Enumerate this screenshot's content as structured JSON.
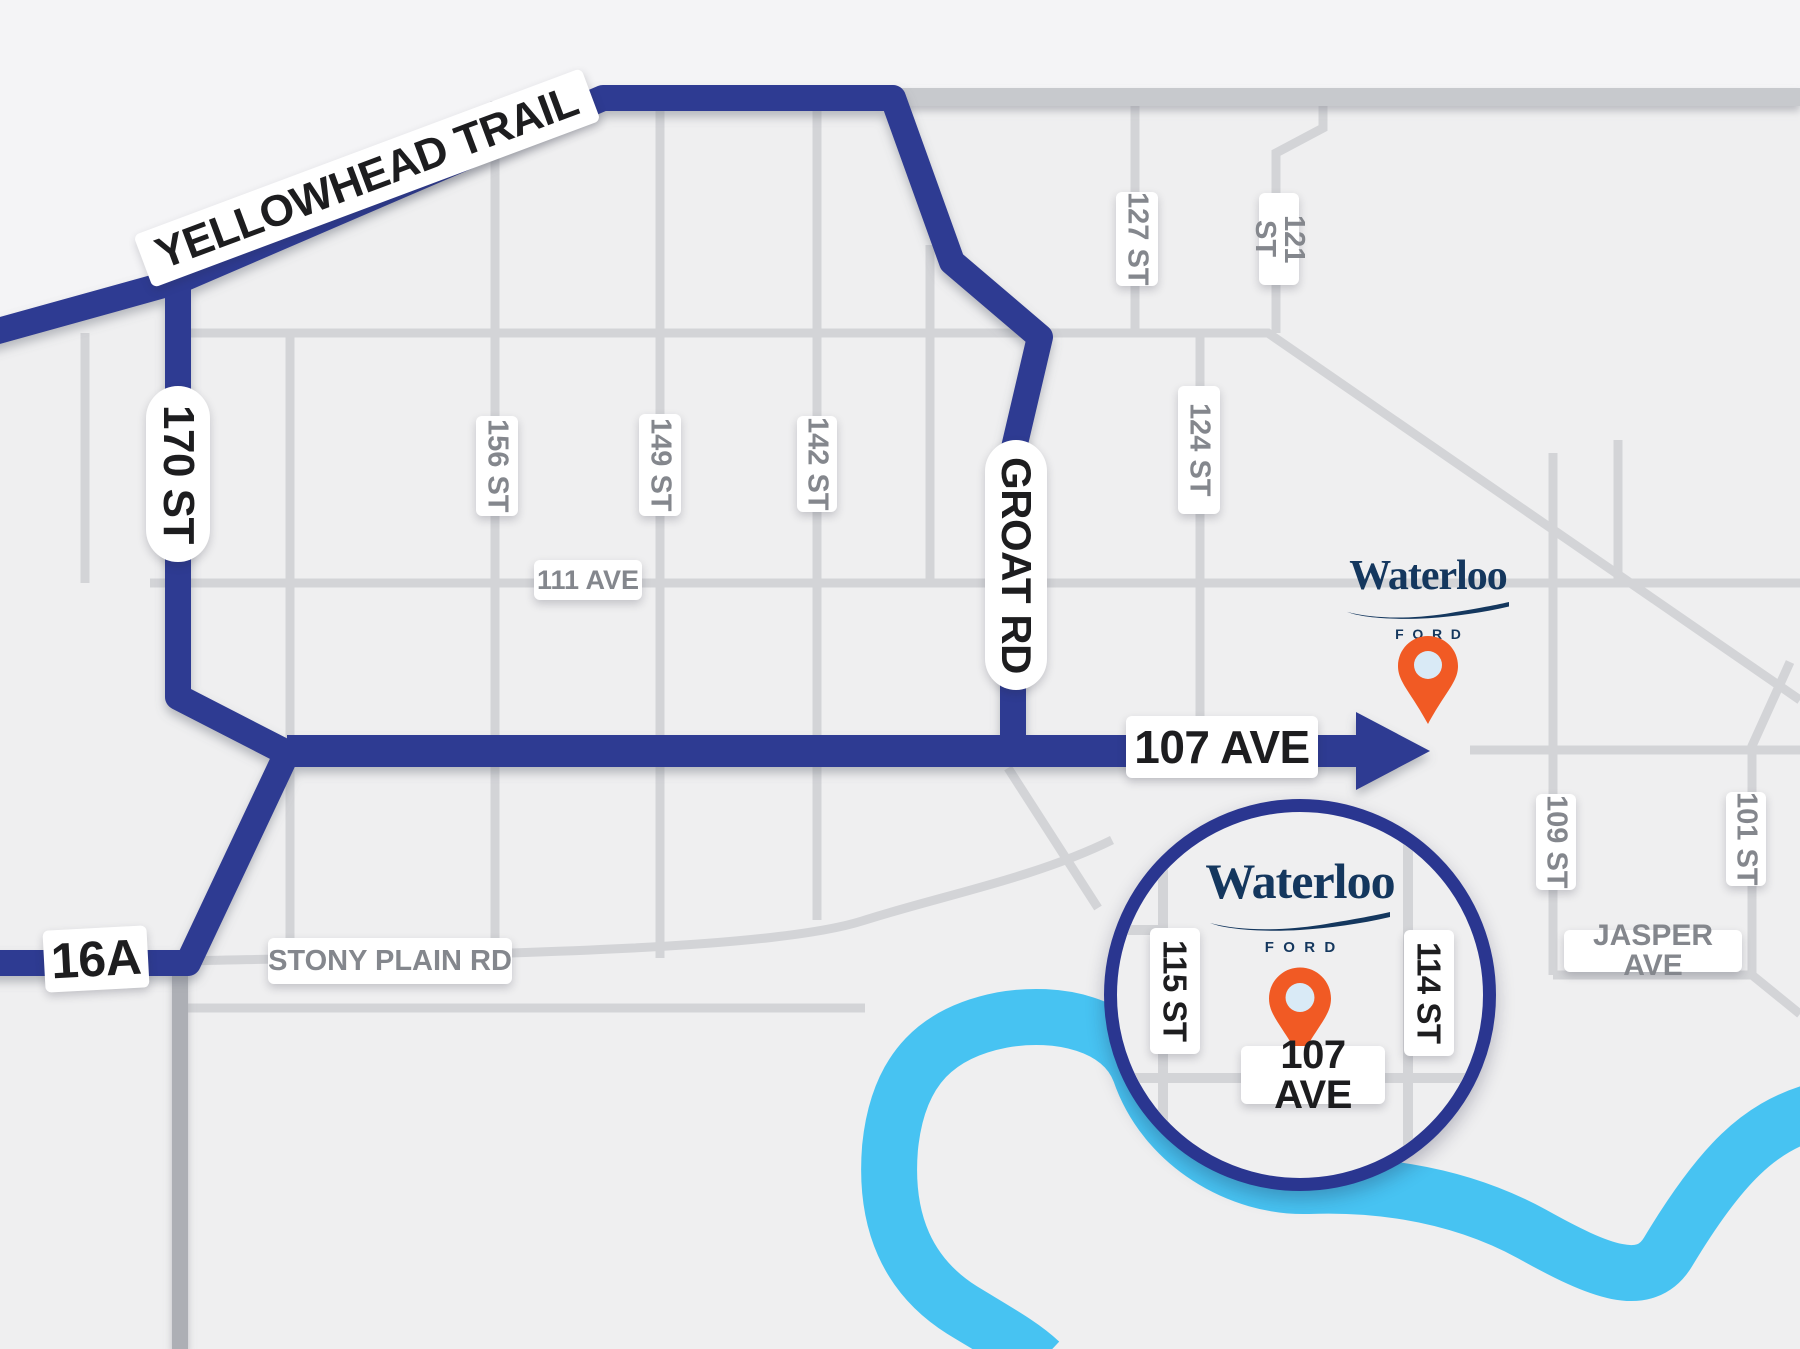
{
  "map_title": "Waterloo Ford directions map",
  "colors": {
    "background": "#EFEFF0",
    "road_gray": "#D3D4D7",
    "road_gray_dark": "#C7C9CD",
    "route_navy": "#2E3B92",
    "river_blue": "#47C3F2",
    "pin_orange": "#F15A24",
    "pin_center": "#D9EAF6",
    "logo_navy": "#14375E",
    "label_black": "#1d1d1f",
    "label_gray": "#84878d"
  },
  "route_labels": {
    "yellowhead": "YELLOWHEAD TRAIL",
    "st170": "170 ST",
    "groat": "GROAT RD",
    "ave107": "107 AVE",
    "hwy16a": "16A"
  },
  "street_labels": {
    "st156": "156 ST",
    "st149": "149 ST",
    "st142": "142 ST",
    "st127": "127 ST",
    "st121": "121 ST",
    "st124": "124 ST",
    "st109": "109 ST",
    "st101": "101 ST",
    "ave111": "111 AVE",
    "stony": "STONY PLAIN RD",
    "jasper": "JASPER AVE"
  },
  "dealership": {
    "name": "Waterloo",
    "brand": "FORD"
  },
  "inset": {
    "st115": "115 ST",
    "st114": "114 ST",
    "ave107": "107 AVE"
  }
}
